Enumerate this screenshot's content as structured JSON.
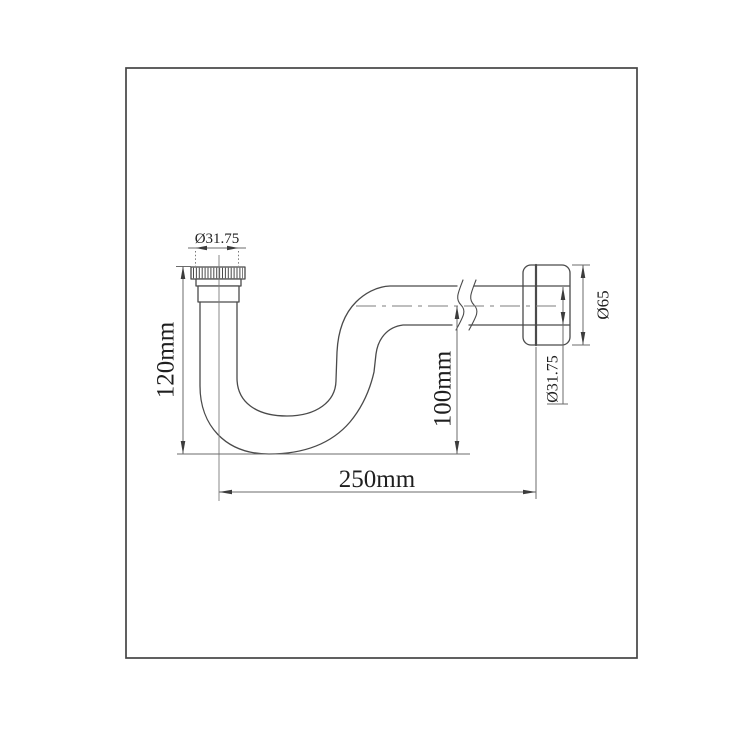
{
  "diagram": {
    "type": "engineering-drawing",
    "subject": "P-trap drain pipe side view with wall flange",
    "colors": {
      "outline": "#4a4a4a",
      "dim_line": "#6b6b6b",
      "centerline": "#7d7d7d",
      "arrow": "#3c3c3c",
      "text": "#1f1f1f",
      "border": "#454545",
      "background": "#ffffff"
    },
    "labels": {
      "inlet_diameter": "Ø31.75",
      "trap_height": "120mm",
      "outlet_center_height": "100mm",
      "overall_length": "250mm",
      "flange_diameter": "Ø65",
      "outlet_pipe_diameter": "Ø31.75"
    }
  }
}
